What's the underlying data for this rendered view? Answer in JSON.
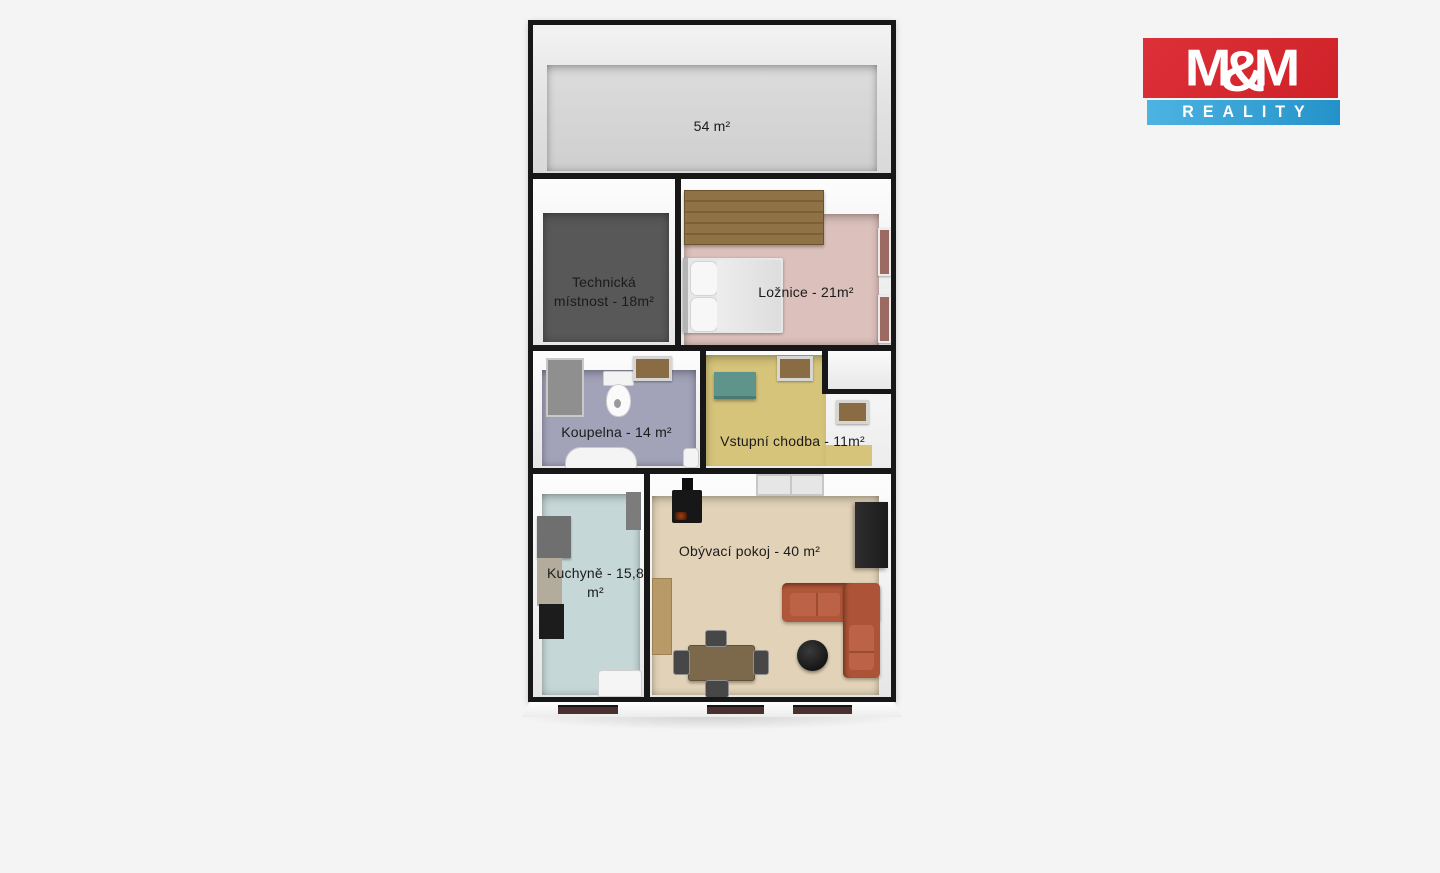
{
  "background_color": "#f4f4f4",
  "logo": {
    "m_left": "M",
    "amp": "&",
    "m_right": "M",
    "bottom_text": "REALITY",
    "red_color": "#d7272e",
    "blue_color": "#2d9fd6"
  },
  "floorplan": {
    "wall_color": "#171717",
    "rooms": [
      {
        "name": "attic",
        "label": "54 m²",
        "floor_color": "#d6d6d6"
      },
      {
        "name": "technical-room",
        "label": "Technická místnost - 18m²",
        "floor_color": "#585858"
      },
      {
        "name": "bedroom",
        "label": "Ložnice - 21m²",
        "floor_color": "#dcc0bb"
      },
      {
        "name": "bathroom",
        "label": "Koupelna - 14 m²",
        "floor_color": "#a2a2b9"
      },
      {
        "name": "entrance-hall",
        "label": "Vstupní chodba - 11m²",
        "floor_color": "#d6c47a"
      },
      {
        "name": "kitchen",
        "label": "Kuchyně - 15,8 m²",
        "floor_color": "#c6d7d7"
      },
      {
        "name": "living-room",
        "label": "Obývací pokoj - 40 m²",
        "floor_color": "#e2d3b8"
      }
    ],
    "facade_window_color": "#4a302e"
  }
}
